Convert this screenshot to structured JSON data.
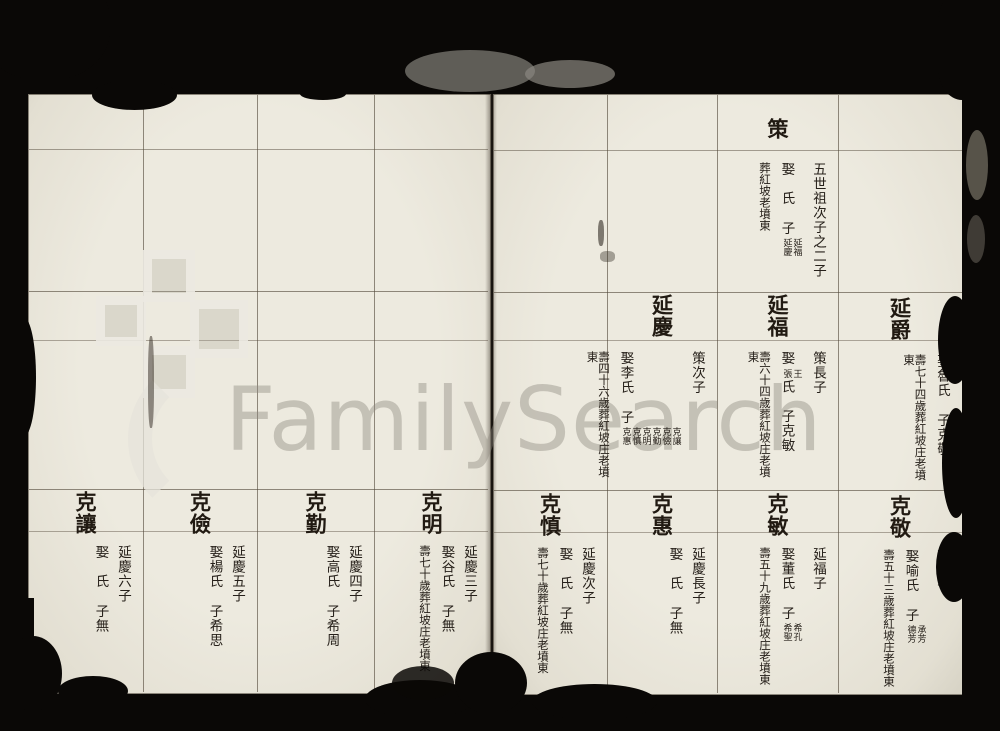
{
  "watermark": {
    "text": "FamilySearch",
    "logo": "familysearch-squares-logo"
  },
  "paper_color": "#edeadf",
  "ink_color": "#26201a",
  "entries": [
    {
      "name": "策",
      "relation": "五世祖次子之二子",
      "marriage": {
        "head": "娶　氏",
        "note": "",
        "tail": "",
        "sons": "子",
        "sons_note": "延福延慶"
      },
      "burial": "葬紅坡老墳東"
    },
    {
      "name": "延慶",
      "relation": "策次子",
      "marriage": {
        "head": "娶李氏",
        "note": "",
        "tail": "",
        "sons": "子",
        "sons_note": "克讓克儉克勤克明克慎克惠"
      },
      "burial": "壽四十六歲葬紅坡庄老墳東"
    },
    {
      "name": "延福",
      "relation": "策長子",
      "marriage": {
        "head": "娶",
        "note": "王張",
        "tail": "氏",
        "sons": "子克敏",
        "sons_note": ""
      },
      "burial": "壽六十四歲葬紅坡庄老墳東"
    },
    {
      "name": "延爵",
      "relation": "",
      "marriage": {
        "head": "娶魯氏",
        "note": "",
        "tail": "",
        "sons": "子克敬",
        "sons_note": ""
      },
      "burial": "壽七十四歲葬紅坡庄老墳東"
    },
    {
      "name": "克讓",
      "relation": "延慶六子",
      "marriage": {
        "head": "娶　氏",
        "note": "",
        "tail": "",
        "sons": "子無",
        "sons_note": ""
      },
      "burial": ""
    },
    {
      "name": "克儉",
      "relation": "延慶五子",
      "marriage": {
        "head": "娶楊氏",
        "note": "",
        "tail": "",
        "sons": "子希思",
        "sons_note": ""
      },
      "burial": ""
    },
    {
      "name": "克勤",
      "relation": "延慶四子",
      "marriage": {
        "head": "娶高氏",
        "note": "",
        "tail": "",
        "sons": "子希周",
        "sons_note": ""
      },
      "burial": ""
    },
    {
      "name": "克明",
      "relation": "延慶三子",
      "marriage": {
        "head": "娶谷氏",
        "note": "",
        "tail": "",
        "sons": "子無",
        "sons_note": ""
      },
      "burial": "壽七十歲葬紅坡庄老墳東"
    },
    {
      "name": "克慎",
      "relation": "延慶次子",
      "marriage": {
        "head": "娶　氏",
        "note": "",
        "tail": "",
        "sons": "子無",
        "sons_note": ""
      },
      "burial": "壽七十歲葬紅坡庄老墳東"
    },
    {
      "name": "克惠",
      "relation": "延慶長子",
      "marriage": {
        "head": "娶　氏",
        "note": "",
        "tail": "",
        "sons": "子無",
        "sons_note": ""
      },
      "burial": ""
    },
    {
      "name": "克敏",
      "relation": "延福子",
      "marriage": {
        "head": "娶董氏",
        "note": "",
        "tail": "",
        "sons": "子",
        "sons_note": "希孔希聖"
      },
      "burial": "壽五十九歲葬紅坡庄老墳東"
    },
    {
      "name": "克敬",
      "relation": "延爵子",
      "marriage": {
        "head": "娶喻氏",
        "note": "",
        "tail": "",
        "sons": "子",
        "sons_note": "承芳德芳"
      },
      "burial": "壽五十三歲葬紅坡庄老墳東"
    }
  ]
}
